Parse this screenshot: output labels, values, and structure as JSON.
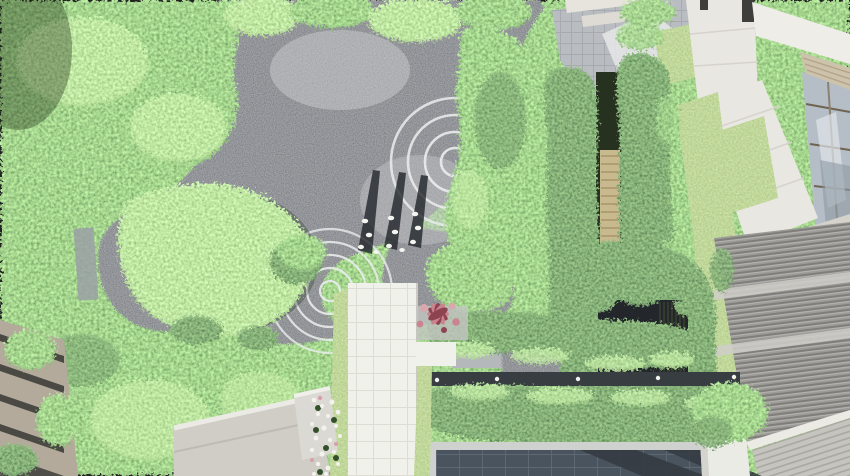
{
  "meta": {
    "title": "Top-down aerial rendering of a landscaped courtyard garden",
    "render_type": "architectural landscape visualization",
    "view": "plan / bird's-eye view"
  },
  "palette": {
    "foliage_base": "#6b8f4e",
    "foliage_light": "#a9c77e",
    "foliage_dark": "#3c5a2d",
    "lawn": "#86a855",
    "lawn_deep": "#5d7f3f",
    "gravel_dark": "#3a4046",
    "gravel_light": "#7f868c",
    "ripple_stroke": "#eaecec",
    "shadow_dark": "#20262b",
    "bird_white": "#f4f4f0",
    "path_white": "#f1f1ec",
    "path_grid": "#deddd4",
    "slab_gray": "#b5b8ba",
    "paving_gray": "#b9bdc2",
    "paving_grid": "#a7abb0",
    "building_white": "#e9e7e1",
    "building_shade": "#d4d2ca",
    "awning_tan": "#cdc2ab",
    "awning_line": "#b3a488",
    "glass_blue": "#b5bec6",
    "glass_frame": "#6f6352",
    "louver_gray": "#9c9b97",
    "louver_dark": "#7f7e7a",
    "louver_light": "#b6b5b1",
    "deck_gray": "#c6c4be",
    "deck_line": "#a9a7a1",
    "pool_slate": "#4a545e",
    "pool_grid": "#5d6873",
    "pool_shadow": "#343b42",
    "coping": "#ced1ce",
    "stone_band": "#383d42",
    "light_dot": "#f2f2ee",
    "screen_tan": "#c8b98e",
    "screen_line": "#a08f62",
    "maple_pink": "#c9848f",
    "maple_deep": "#8e4350",
    "flower_white": "#f3f2ec",
    "facade_beige": "#b3aa9b",
    "window_dark": "#3e3e3a",
    "planter_white": "#ebebe6",
    "courtyard_dark": "#23272b"
  },
  "scene": {
    "view": "Aerial top-down rendering of a courtyard garden with gravel water garden, ripple circles, hedges, pool and buildings",
    "gravel_garden": {
      "ripple_sets": [
        {
          "name": "upper-ripple",
          "cx": 455,
          "cy": 162,
          "radii": [
            14,
            30,
            47,
            64
          ]
        },
        {
          "name": "lower-ripple",
          "cx": 330,
          "cy": 291,
          "radii": [
            10,
            23,
            36,
            49,
            62
          ]
        }
      ],
      "bird_count": 11,
      "shadow_streak_count": 3
    },
    "regions": [
      {
        "name": "tree-canopy",
        "desc": "dense green tree canopy over left half and top"
      },
      {
        "name": "gravel-garden",
        "desc": "dark gravel water garden with raked white ripple rings and white birds"
      },
      {
        "name": "walkway",
        "desc": "white tiled walkway running from bottom edge into the garden"
      },
      {
        "name": "japanese-maple",
        "desc": "pink/red maple beside the walkway head"
      },
      {
        "name": "hedge-rows",
        "desc": "clipped hedge bands with stone strip and path lights above the pool"
      },
      {
        "name": "bamboo-screen",
        "desc": "double column of tall planting with tan slatted screen"
      },
      {
        "name": "reflecting-pool",
        "desc": "dark slate tiled pool at bottom"
      },
      {
        "name": "white-building",
        "desc": "white stone-clad building volumes with glazing, upper right"
      },
      {
        "name": "louver-roof",
        "desc": "gray louvered metal roof, lower right"
      },
      {
        "name": "pavilion-roof",
        "desc": "light gray pavilion canopy, lower left"
      },
      {
        "name": "flower-bed",
        "desc": "strip of small white flowers beside pavilion"
      },
      {
        "name": "left-building",
        "desc": "banded facade of neighbouring building at far left"
      }
    ],
    "path_light_count": 5
  }
}
